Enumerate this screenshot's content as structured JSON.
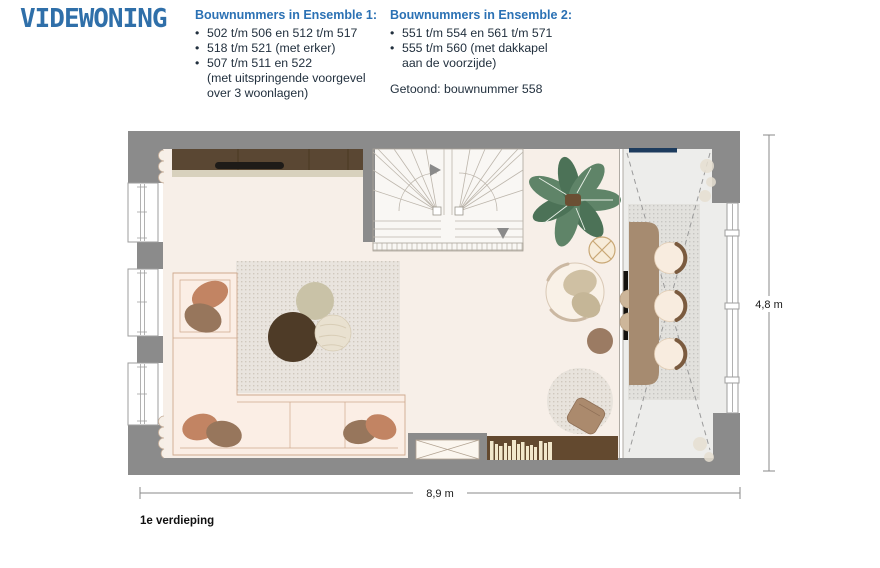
{
  "bullet_char": "•",
  "logo": {
    "text": "VIDEWONING",
    "color": "#2f6fa9"
  },
  "ensembles": [
    {
      "title": "Bouwnummers in Ensemble 1:",
      "lines": [
        {
          "bullet": true,
          "text": "502 t/m 506 en 512 t/m 517"
        },
        {
          "bullet": true,
          "text": "518 t/m 521 (met erker)"
        },
        {
          "bullet": true,
          "text": "507 t/m 511 en 522"
        },
        {
          "bullet": false,
          "text": "(met uitspringende voorgevel"
        },
        {
          "bullet": false,
          "text": "over 3 woonlagen)"
        }
      ]
    },
    {
      "title": "Bouwnummers in Ensemble 2:",
      "lines": [
        {
          "bullet": true,
          "text": "551 t/m 554 en 561 t/m 571"
        },
        {
          "bullet": true,
          "text": "555 t/m 560 (met dakkapel"
        },
        {
          "bullet": false,
          "text": "aan de voorzijde)"
        }
      ],
      "note": "Getoond: bouwnummer 558"
    }
  ],
  "plan": {
    "floor_label": "1e verdieping",
    "dimension_width": "8,9 m",
    "dimension_height": "4,8 m",
    "shown_unit": "558",
    "colors": {
      "wall": "#8b8b8b",
      "floor_living": "#f7efe8",
      "floor_dining": "#ededeb",
      "accent_blue": "#2b71b4",
      "dormer_window": "#1d3c5e",
      "cabinet_brown": "#5a4733",
      "plant_green": "#5f8468",
      "dining_table": "#a68b70"
    }
  }
}
